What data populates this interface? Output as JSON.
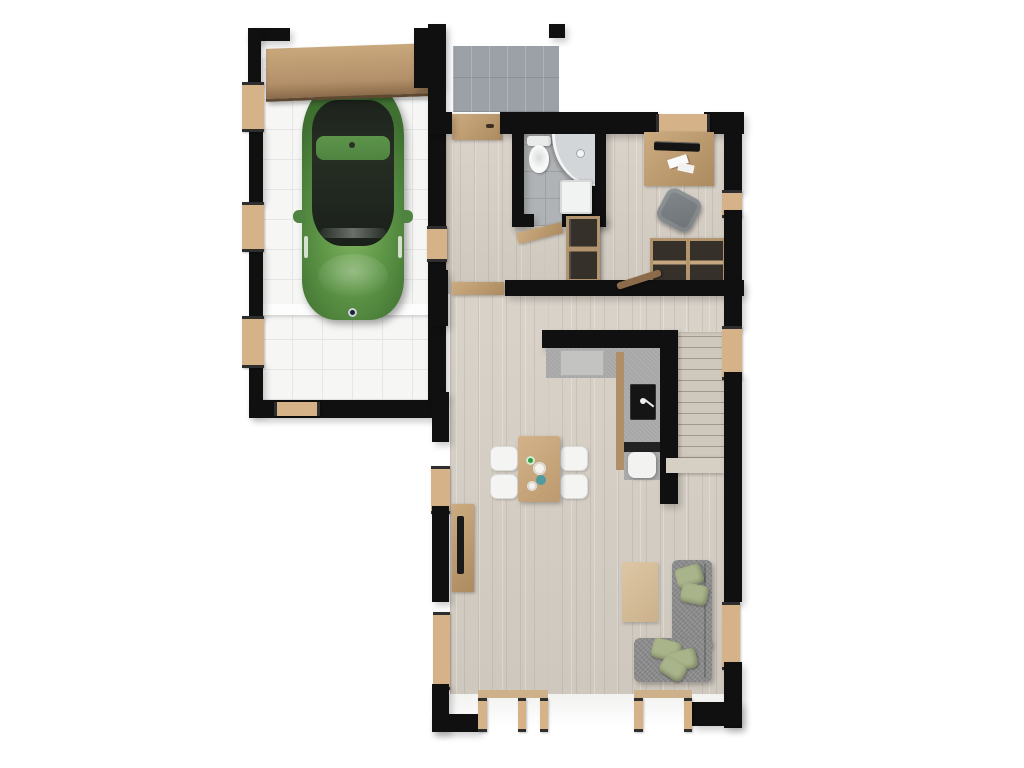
{
  "scene": {
    "label": "3D top-down floor plan render, ground floor with attached garage",
    "view": "top-down axonometric",
    "background": "#ffffff"
  },
  "palette": {
    "wall_cut": "#101010",
    "wood_floor": "#d7d0c6",
    "garage_tile": "#f6f6f5",
    "porch_concrete": "#9ba1a6",
    "bathroom_tile": "#b0b3b5",
    "furniture_wood": "#c2a077",
    "window_frame": "#d6b289",
    "car_green": "#5f9748",
    "car_glass": "#20261f",
    "sofa_gray": "#8b8b8b",
    "cushion_green": "#a9b48a",
    "counter_gray": "#a7a7a7",
    "sink_black": "#151515"
  },
  "rooms": {
    "garage": {
      "label": "Garage with white tiled floor and green car"
    },
    "porch": {
      "label": "Entry porch with gray concrete tiles"
    },
    "hallway": {
      "label": "Entry hallway, wood floor"
    },
    "bathroom": {
      "label": "Bathroom with toilet, corner shower and washer"
    },
    "office": {
      "label": "Office nook with desk, chair and shelving"
    },
    "kitchen": {
      "label": "L-shaped kitchen with black sink"
    },
    "living": {
      "label": "Open living / dining room, wood floor"
    },
    "stairs": {
      "label": "Staircase to upper floor"
    }
  },
  "items": {
    "car": {
      "label": "Green car parked in garage"
    },
    "garage_door": {
      "label": "Wooden sectional garage door"
    },
    "front_door": {
      "label": "Front entrance door"
    },
    "toilet": {
      "label": "Toilet"
    },
    "shower": {
      "label": "Corner shower"
    },
    "washer": {
      "label": "Washing machine"
    },
    "hall_cabinet": {
      "label": "Hall shelving cabinet"
    },
    "desk": {
      "label": "Desk with monitor and papers"
    },
    "office_chair": {
      "label": "Office chair"
    },
    "shelving_unit": {
      "label": "Open shelving sideboard"
    },
    "kitchen_counter": {
      "label": "Kitchen counter with cooktop"
    },
    "kitchen_sink": {
      "label": "Black kitchen sink with faucet"
    },
    "dining_table": {
      "label": "Dining table with tableware"
    },
    "dining_chairs": {
      "label": "Four white dining chairs"
    },
    "tv_console": {
      "label": "TV console with flat TV"
    },
    "coffee_table": {
      "label": "Coffee table"
    },
    "sofa": {
      "label": "Gray corner sofa with green cushions"
    },
    "railing": {
      "label": "Stair handrail"
    },
    "windows": {
      "label": "Windows with wooden frames"
    },
    "patio_doors": {
      "label": "Bottom patio window doors"
    }
  }
}
